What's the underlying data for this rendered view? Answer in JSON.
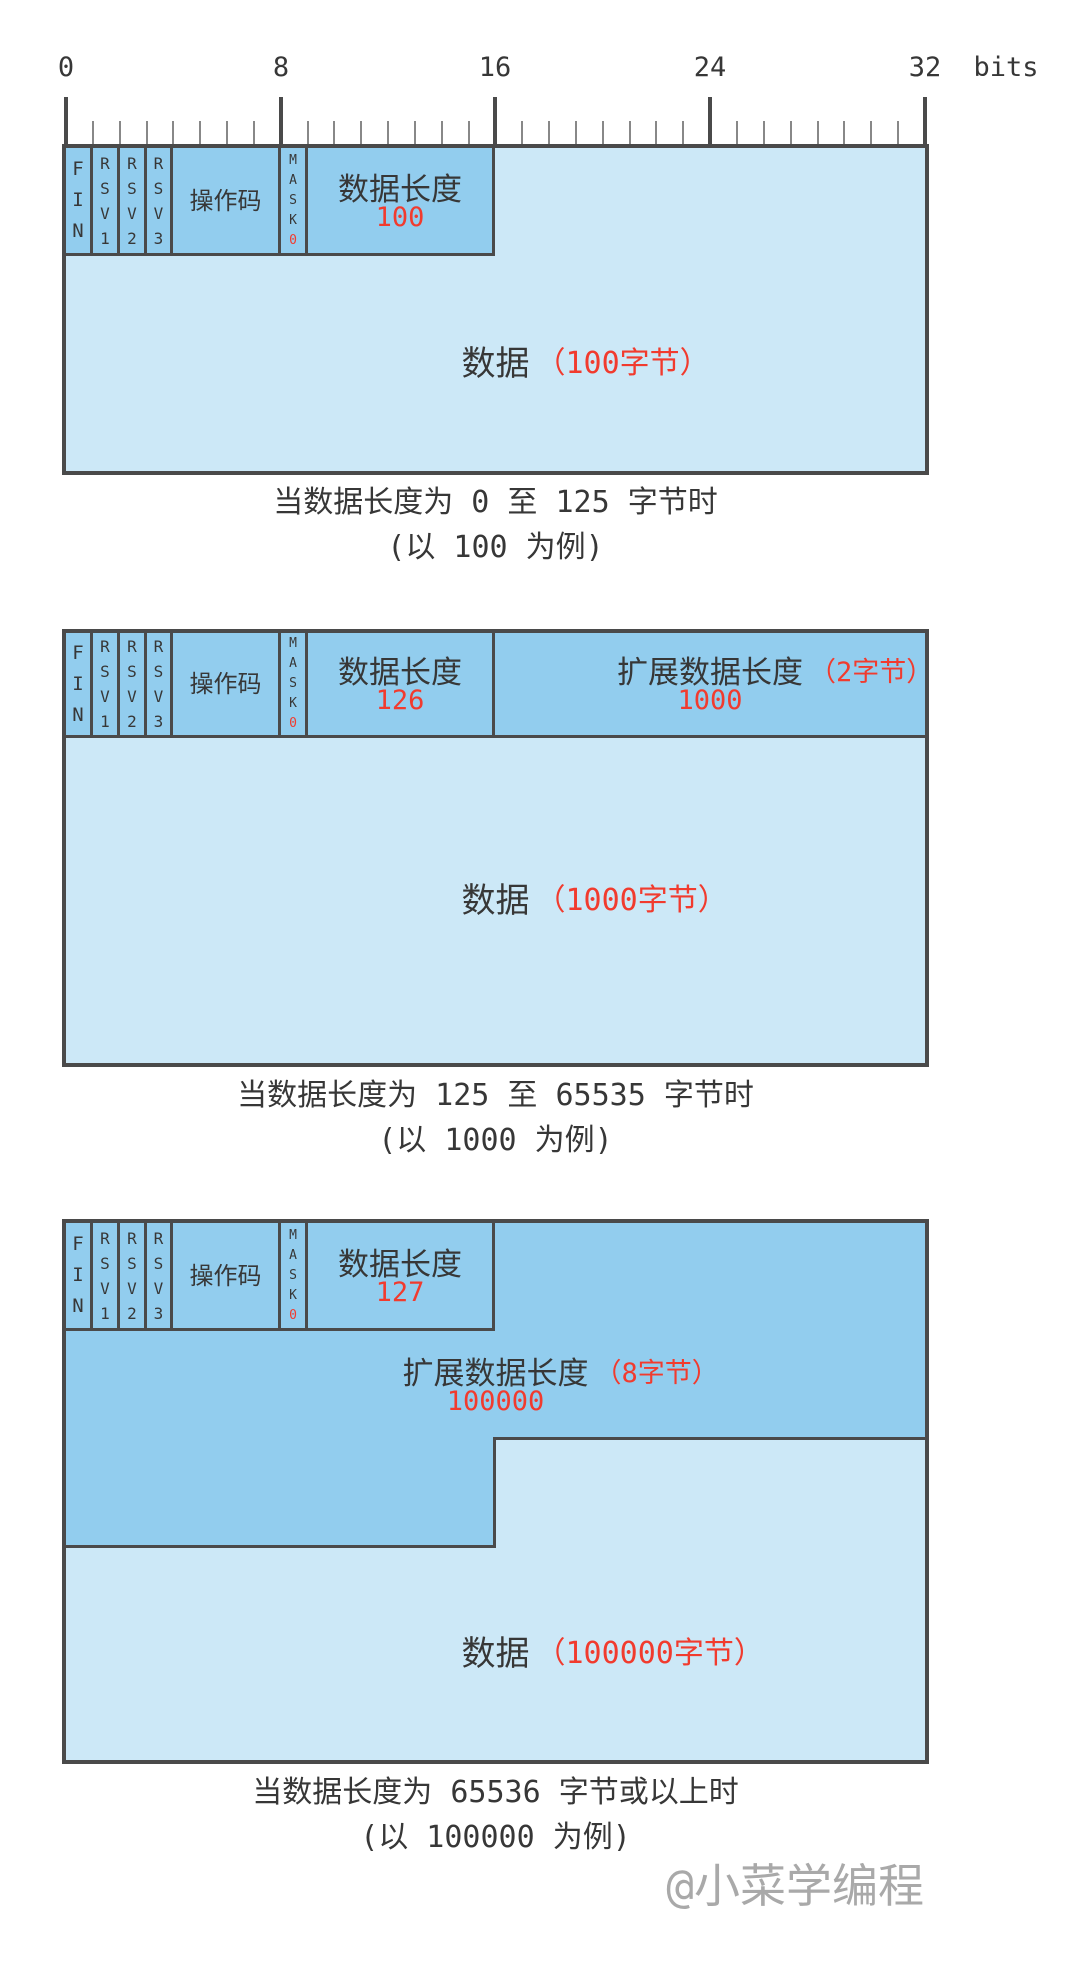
{
  "colors": {
    "field_blue": "#92CDEE",
    "payload_blue": "#CCE8F7",
    "border_gray": "#4A4A4A",
    "accent_red": "#F13B2E",
    "text_dark": "#373737",
    "tick_gray": "#888888",
    "watermark_gray": "#A9A9A9"
  },
  "ruler": {
    "tick_labels": [
      "0",
      "8",
      "16",
      "24",
      "32"
    ],
    "unit_label": "bits",
    "total_bits": 32,
    "major_every": 8
  },
  "fields": {
    "fin": "FIN",
    "rsv1": "RSV1",
    "rsv2": "RSV2",
    "rsv3": "RSV3",
    "opcode": "操作码",
    "mask": "MASK",
    "mask_bit": "0",
    "payload_length": "数据长度",
    "extended_length": "扩展数据长度",
    "payload": "数据"
  },
  "diagrams": [
    {
      "payload_length_value": "100",
      "payload_note": "（100字节）",
      "caption_line1": "当数据长度为 0 至 125 字节时",
      "caption_line2": "(以 100 为例)"
    },
    {
      "payload_length_value": "126",
      "extended_note": "（2字节）",
      "extended_value": "1000",
      "payload_note": "（1000字节）",
      "caption_line1": "当数据长度为 125 至 65535 字节时",
      "caption_line2": "(以 1000 为例)"
    },
    {
      "payload_length_value": "127",
      "extended_note": "（8字节）",
      "extended_value": "100000",
      "payload_note": "（100000字节）",
      "caption_line1": "当数据长度为 65536 字节或以上时",
      "caption_line2": "(以 100000 为例)"
    }
  ],
  "watermark": "@小菜学编程"
}
